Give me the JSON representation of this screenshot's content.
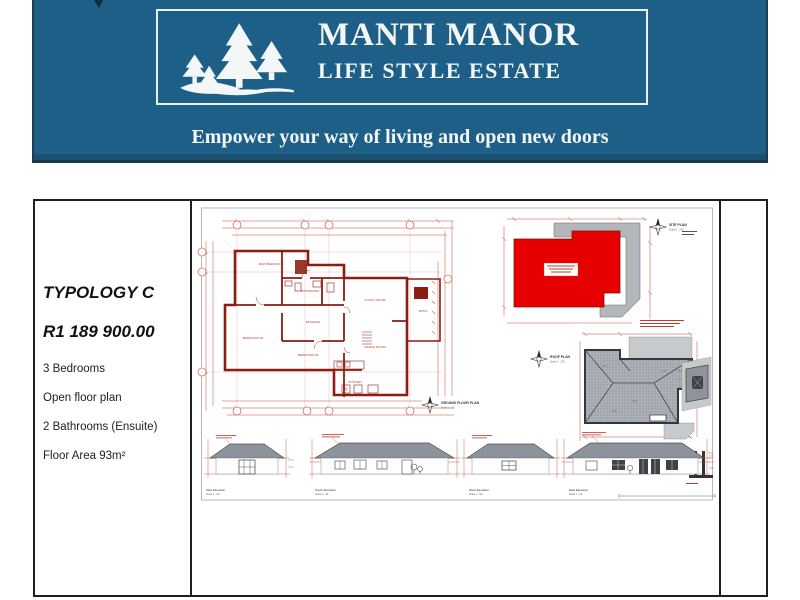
{
  "header": {
    "title": "MANTI MANOR",
    "subtitle": "LIFE STYLE ESTATE",
    "tagline": "Empower your way of living and open new doors",
    "logo_icon": "pine-trees",
    "colors": {
      "banner": "#1E5F87",
      "banner_edge": "#1B3F55",
      "text": "#F3F7F8"
    }
  },
  "listing": {
    "typology": "TYPOLOGY C",
    "price": "R1 189 900.00",
    "features": [
      "3 Bedrooms",
      "Open floor plan",
      "2 Bathrooms (Ensuite)",
      "Floor Area 93m²"
    ]
  },
  "drawings": {
    "ground_floor_plan": {
      "label": "GROUND FLOOR PLAN",
      "scale": "Scale 1 : 50",
      "rooms": [
        "MAIN BEDROOM",
        "BEDROOM 02",
        "BEDROOM 03",
        "BATHROOM",
        "PASSAGE",
        "LIVING ROOM",
        "DINING ROOM",
        "KITCHEN",
        "PATIO"
      ]
    },
    "site_plan": {
      "label": "SITE PLAN",
      "scale": "Scale 1 : 200"
    },
    "roof_plan": {
      "label": "ROOF PLAN",
      "scale": "Scale 1 : 100"
    },
    "elevations": [
      {
        "label": "Side Elevation",
        "scale": "Scale 1 : 50"
      },
      {
        "label": "South Elevation",
        "scale": "Scale 1 : 50"
      },
      {
        "label": "West Elevation",
        "scale": "Scale 1 : 50"
      },
      {
        "label": "East Elevation",
        "scale": "Scale 1 : 50"
      }
    ],
    "colors": {
      "linework_red": "#C0392B",
      "wall_red": "#8C1D12",
      "footprint_red": "#E60000",
      "roof_gray": "#ADB2B8",
      "paving_gray": "#B3B7BB"
    }
  }
}
